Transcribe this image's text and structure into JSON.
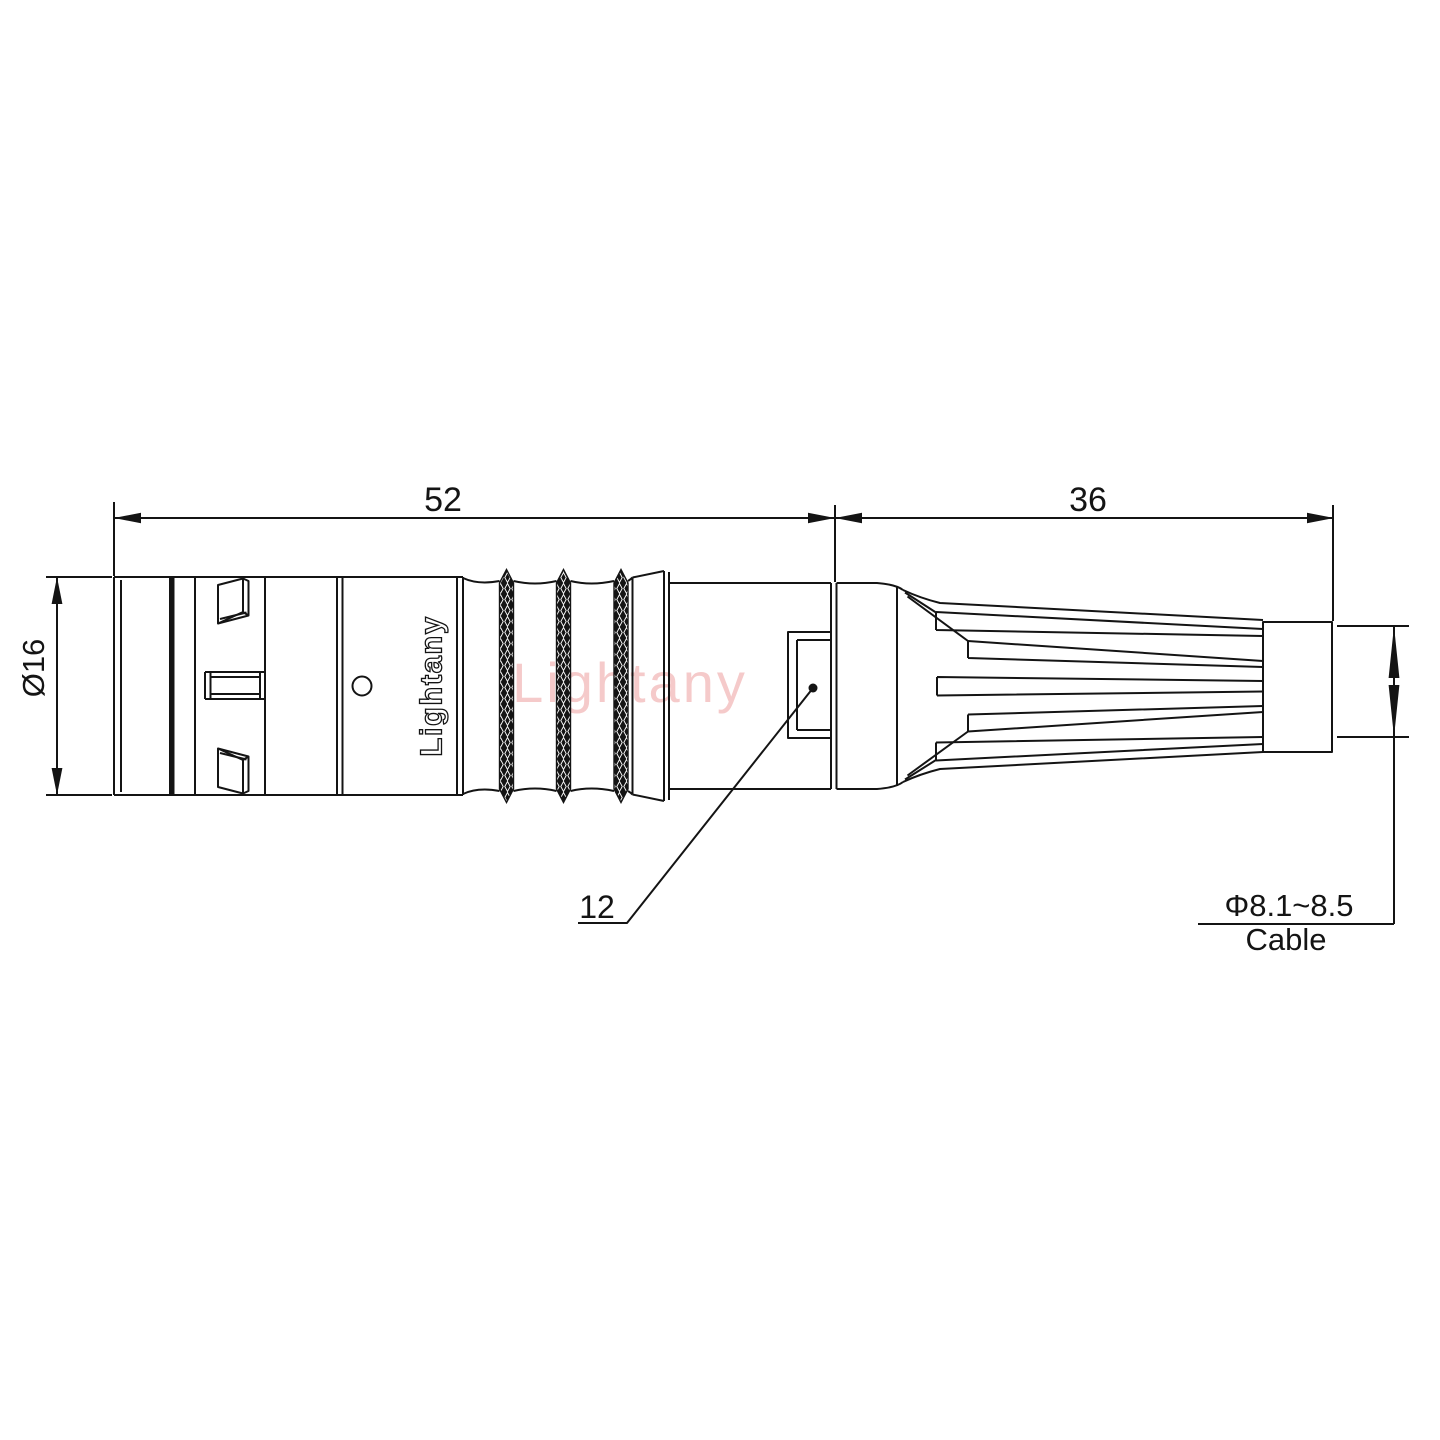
{
  "drawing": {
    "dimensions": {
      "front_length": "52",
      "boot_length": "36",
      "body_diameter": "Ø16",
      "latch_sleeve_size": "12",
      "cable_diameter": "Φ8.1~8.5",
      "cable_label": "Cable"
    },
    "branding": {
      "body_text": "Lightany",
      "watermark_text": "Lightany"
    },
    "colors": {
      "line": "#141414",
      "watermark": "#f5caca",
      "background": "#ffffff"
    }
  }
}
